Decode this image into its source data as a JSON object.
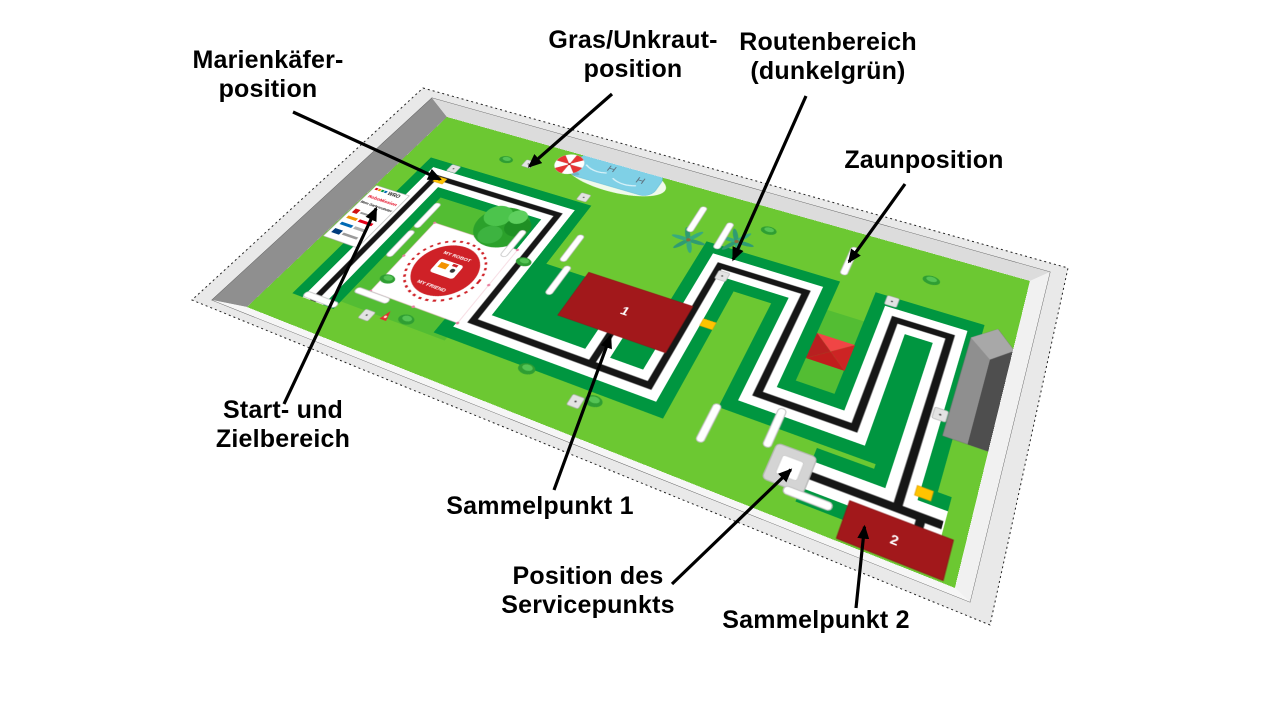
{
  "figure": {
    "kind": "WRO RoboMission competition table diagram",
    "language": "de"
  },
  "annotations": [
    {
      "id": "marienkaefer",
      "text": "Marienkäfer-\nposition"
    },
    {
      "id": "gras",
      "text": "Gras/Unkraut-\nposition"
    },
    {
      "id": "routenbereich",
      "text": "Routenbereich\n(dunkelgrün)"
    },
    {
      "id": "zaun",
      "text": "Zaunposition"
    },
    {
      "id": "start",
      "text": "Start- und\nZielbereich"
    },
    {
      "id": "sammel1",
      "text": "Sammelpunkt 1"
    },
    {
      "id": "service",
      "text": "Position des\nServicepunkts"
    },
    {
      "id": "sammel2",
      "text": "Sammelpunkt 2"
    }
  ],
  "field": {
    "sign": {
      "wro": "WRO",
      "program": "RoboMission",
      "challenge": "Mein Gartenroboter"
    },
    "start_logo": {
      "arc_top": "MY ROBOT",
      "arc_bottom": "MY FRIEND"
    },
    "collection_point_1": "1",
    "collection_point_2": "2"
  },
  "colors": {
    "grass_light": "#6cc832",
    "grass_medium": "#53bd33",
    "route_dark_green": "#009640",
    "route_line": "#161616",
    "collection_red": "#a2181b",
    "marker_yellow": "#ffc400",
    "pool_blue": "#7fd0e6",
    "wall_gray": "#8f8f8f"
  }
}
